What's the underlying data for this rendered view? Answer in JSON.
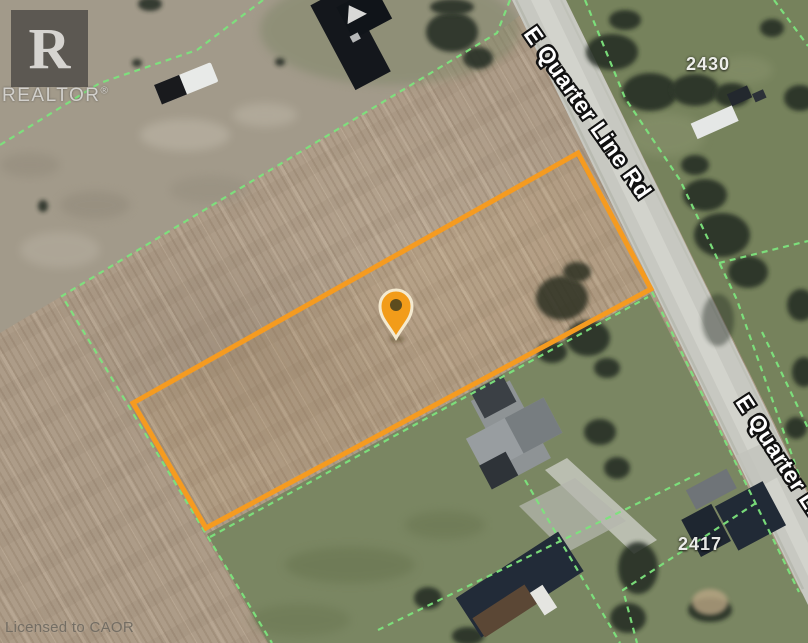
{
  "branding": {
    "logo_letter": "R",
    "wordmark": "REALTOR",
    "registered": "®",
    "license": "Licensed to CAOR"
  },
  "map_labels": {
    "road_upper": "E Quarter Line Rd",
    "road_lower": "E Quarter Line Rd",
    "parcel_north": "2430",
    "parcel_south": "2417"
  },
  "colors": {
    "field": "#AD9C88",
    "grass_north": "#76825C",
    "grass_south": "#7A8662",
    "dirt_strip": "#A29A8A",
    "road": "#C7C8C1",
    "parcel_boundary": "#F59B20",
    "property_line": "#7DE37D",
    "pin": "#F29C1A"
  },
  "icons": {
    "pin": "map-pin-icon"
  }
}
